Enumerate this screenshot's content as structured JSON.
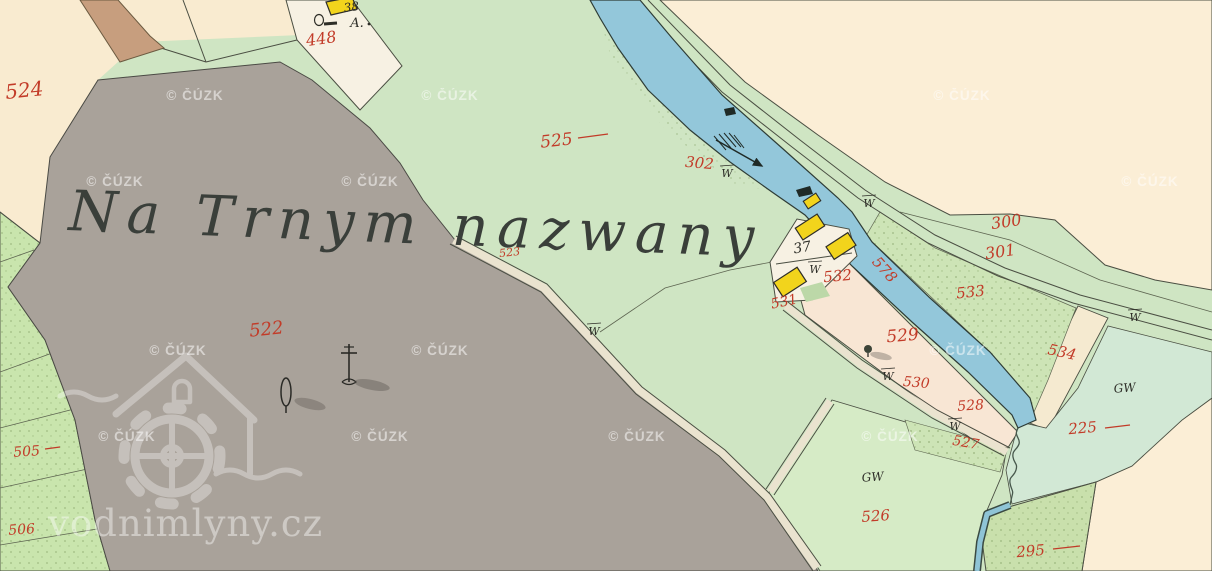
{
  "map": {
    "field_name_inscription": "Na Trnym nazwany",
    "house_numbers": {
      "n37": "37",
      "n38": "38"
    },
    "letters": {
      "a": "A."
    },
    "land_use_marks": {
      "w": "W",
      "gw": "GW"
    },
    "parcels": {
      "p524": "524",
      "p448": "448",
      "p525": "525",
      "p302": "302",
      "p300": "300",
      "p301": "301",
      "p523": "523",
      "p522": "522",
      "p532": "532",
      "p531": "531",
      "p578": "578",
      "p533": "533",
      "p529": "529",
      "p534": "534",
      "p530": "530",
      "p528": "528",
      "p527": "527",
      "p225": "225",
      "p526": "526",
      "p295": "295",
      "p505": "505",
      "p506": "506"
    }
  },
  "watermarks": {
    "cuzk": "© ČÚZK",
    "site": "vodnimlyny.cz"
  },
  "colors": {
    "water_blue": "#93c7da",
    "wooden_building_yellow": "#f2d41c",
    "parcel_number_red": "#c23b28",
    "meadow_green": "#cfe5c3",
    "field_cream": "#f9ebd0",
    "common_land_gray": "#a9a29a"
  }
}
